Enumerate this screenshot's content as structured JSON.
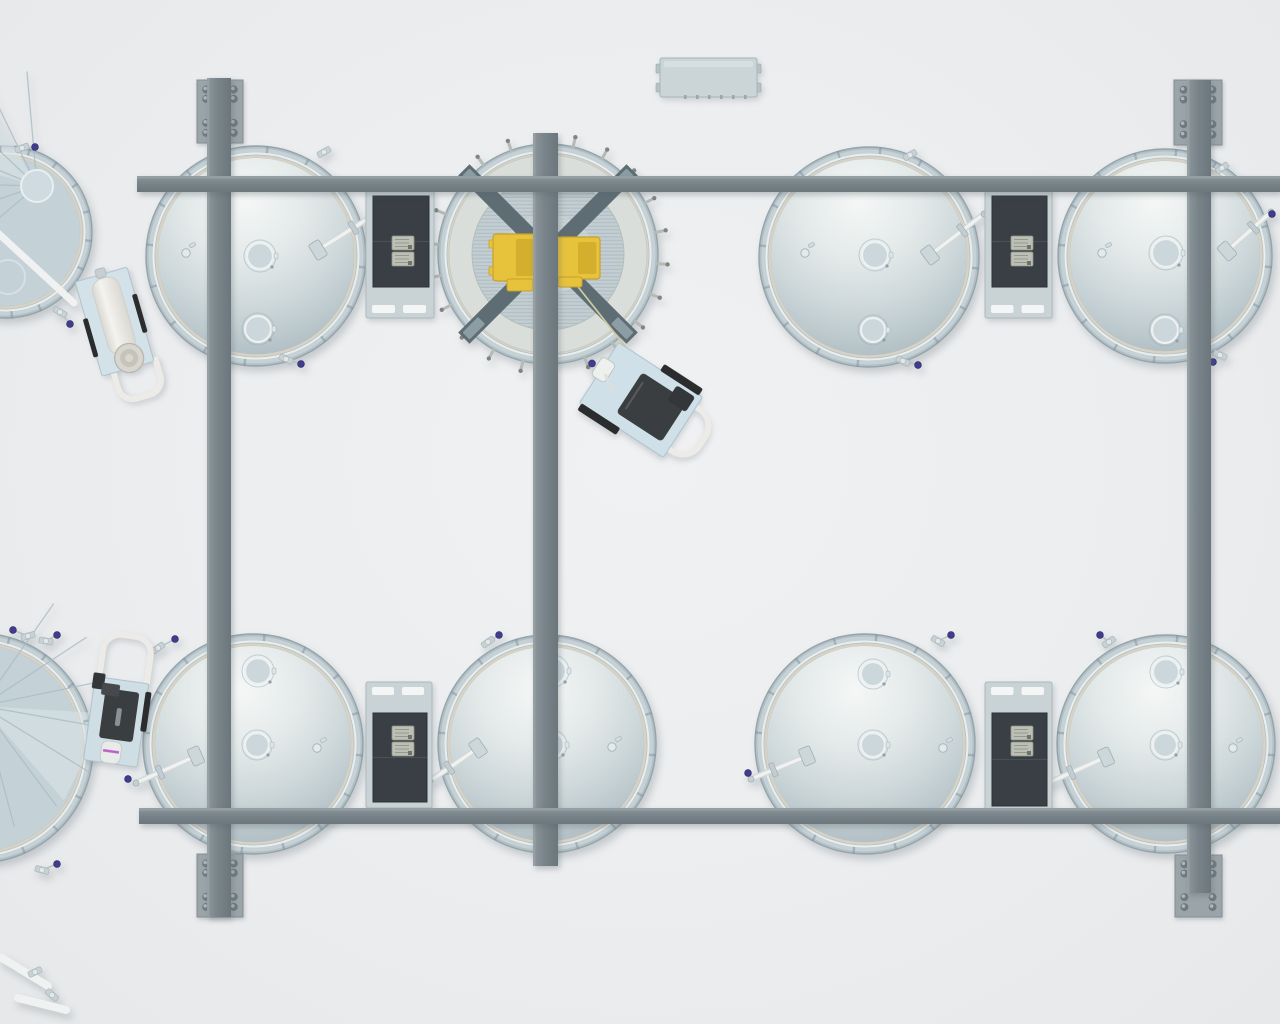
{
  "scene": {
    "canvas": {
      "w": 1280,
      "h": 1024
    },
    "palette": {
      "rim": "#b2c0c6",
      "rim_edge": "#93a4ac",
      "rim_hi": "#c6d1d5",
      "seam_white": "#e9eeee",
      "seam_ring": "#d8d2c4",
      "dome_hi": "#f5f7f6",
      "dome_m1": "#e3e9e9",
      "dome_m2": "#cdd7d9",
      "dome_m3": "#b6c4c9",
      "dome_edge": "#a9b8bf",
      "beam_light": "#8d979c",
      "beam_mid": "#79848a",
      "beam_dark": "#6b767d",
      "plate": "#9ba5a9",
      "plate_edge": "#868f93",
      "bolt": "#6f7a80",
      "bolt_hi": "#adb6ba",
      "panel_base": "#c9d2d5",
      "panel_edge": "#adb9bd",
      "panel_dark": "#393f44",
      "panel_dark_edge": "#2c3235",
      "panel_seam": "#4a5156",
      "keypad": "#bcbfb4",
      "keypad_edge": "#90948b",
      "slot": "#f4f6f6",
      "yellow": "#e7c33c",
      "yellow_dark": "#c79f2b",
      "yellow_shade": "#d4af2e",
      "xbeam": "#5e6d74",
      "xbeam_foot": "#8c9da4",
      "pipe": "#f0f2f1",
      "pipe_shadow": "#d2d9d8",
      "fitting": "#cdd6d9",
      "fitting_edge": "#9fb0b6",
      "knob_purple": "#413c8f",
      "knob_edge": "#26235e",
      "knob_magenta": "#bf5ec6",
      "open_floor": "#dadedb",
      "stripe_a": "#c3ced2",
      "stripe_b": "#b1bec4",
      "open_center": "#ced8da",
      "cone_fill": "#c4d2d8",
      "cone_line": "#a9bcc5",
      "cone_hi": "#d9e3e6",
      "stud": "#b4bab6",
      "stud_tip": "#7e8683",
      "cart_deck": "#d3e2e9",
      "cart_deck_edge": "#b0c3cc",
      "cart_motor": "#3b3e41",
      "cart_bumper": "#2a2c2d",
      "cart_handle": "#edebe7",
      "cylinder_a": "#f4f3ef",
      "cylinder_b": "#d9d8d2",
      "cap": "#d8d6cf",
      "cap_edge": "#b5b3aa",
      "manway_fill": "#cbd7db",
      "manway_edge": "#edf1f2",
      "manway_ring": "#9db0b8",
      "tick": "#7f929b"
    },
    "tanks": [
      {
        "id": "tank-top-far-left",
        "type": "cone",
        "cx": 6,
        "cy": 232,
        "r": 86,
        "apex": {
          "x": 37,
          "y": 186,
          "r": 16
        },
        "fan": {
          "ax": 37,
          "ay": 186,
          "from": 140,
          "to": 265,
          "n": 7,
          "len": 115
        },
        "pipe": {
          "x1": -14,
          "y1": 222,
          "x2": 74,
          "y2": 303
        },
        "extra_circle": {
          "x": 8,
          "y": 277,
          "r": 17
        },
        "fittings": [
          {
            "x": 22,
            "y": 148,
            "rot": -20,
            "knob": {
              "x": 35,
              "y": 147
            }
          },
          {
            "x": 60,
            "y": 312,
            "rot": 30,
            "knob": {
              "x": 70,
              "y": 324
            }
          }
        ]
      },
      {
        "id": "tank-top-1",
        "type": "closed",
        "cx": 256,
        "cy": 256,
        "r": 110,
        "manways": [
          {
            "x": 260,
            "y": 256,
            "r": 13
          },
          {
            "x": 258,
            "y": 329,
            "r": 13
          }
        ],
        "glyph": {
          "x": 186,
          "y": 253
        },
        "arm": {
          "x1": 318,
          "y1": 250,
          "x2": 377,
          "y2": 213,
          "knob": {
            "x": 380,
            "y": 219
          }
        },
        "fittings": [
          {
            "x": 324,
            "y": 152,
            "rot": -30
          },
          {
            "x": 286,
            "y": 359,
            "rot": 25,
            "knob": {
              "x": 301,
              "y": 364
            }
          }
        ]
      },
      {
        "id": "tank-top-2-open",
        "type": "open",
        "cx": 548,
        "cy": 254,
        "r": 110,
        "floor_r": 99,
        "stripe_r": 76,
        "cross_len": 238,
        "cross_w": 16,
        "studs": 22,
        "rod": {
          "x1": 560,
          "y1": 264,
          "x2": 628,
          "y2": 350
        },
        "motors": [
          {
            "x": 493,
            "y": 234,
            "w": 44,
            "h": 47,
            "tab": {
              "x": 507,
              "y": 279,
              "w": 26,
              "h": 12
            }
          },
          {
            "x": 554,
            "y": 237,
            "w": 46,
            "h": 42,
            "tab": {
              "x": 558,
              "y": 277,
              "w": 24,
              "h": 10
            }
          }
        ]
      },
      {
        "id": "tank-top-3",
        "type": "closed",
        "cx": 869,
        "cy": 257,
        "r": 110,
        "manways": [
          {
            "x": 875,
            "y": 255,
            "r": 13
          },
          {
            "x": 873,
            "y": 330,
            "r": 12
          }
        ],
        "glyph": {
          "x": 805,
          "y": 253
        },
        "arm": {
          "x1": 930,
          "y1": 255,
          "x2": 984,
          "y2": 214,
          "knob": {
            "x": 995,
            "y": 220
          }
        },
        "fittings": [
          {
            "x": 910,
            "y": 155,
            "rot": -30
          },
          {
            "x": 903,
            "y": 361,
            "rot": 25,
            "knob": {
              "x": 918,
              "y": 365
            }
          }
        ]
      },
      {
        "id": "tank-top-4",
        "type": "closed",
        "cx": 1165,
        "cy": 256,
        "r": 107,
        "manways": [
          {
            "x": 1166,
            "y": 253,
            "r": 14
          },
          {
            "x": 1165,
            "y": 330,
            "r": 13
          }
        ],
        "glyph": {
          "x": 1102,
          "y": 253
        },
        "arm": {
          "x1": 1227,
          "y1": 251,
          "x2": 1271,
          "y2": 212,
          "knob": {
            "x": 1272,
            "y": 214
          }
        },
        "fittings": [
          {
            "x": 1222,
            "y": 168,
            "rot": -35
          },
          {
            "x": 1220,
            "y": 355,
            "rot": 25,
            "knob": {
              "x": 1213,
              "y": 362
            }
          }
        ]
      },
      {
        "id": "tank-bottom-far-left",
        "type": "cone",
        "cx": -22,
        "cy": 748,
        "r": 115,
        "apex": {
          "x": -18,
          "y": 706,
          "r": 15
        },
        "fan": {
          "ax": -18,
          "ay": 706,
          "from": -55,
          "to": 75,
          "n": 7,
          "len": 125
        },
        "pipes": [
          {
            "x1": 2,
            "y1": 958,
            "x2": 48,
            "y2": 986
          },
          {
            "x1": 18,
            "y1": 998,
            "x2": 66,
            "y2": 1010
          }
        ],
        "fittings": [
          {
            "x": 28,
            "y": 636,
            "rot": -15,
            "knob": {
              "x": 13,
              "y": 630
            }
          },
          {
            "x": 46,
            "y": 641,
            "rot": 10,
            "knob": {
              "x": 57,
              "y": 635
            }
          },
          {
            "x": 42,
            "y": 870,
            "rot": 15,
            "knob": {
              "x": 57,
              "y": 864
            }
          },
          {
            "x": 35,
            "y": 972,
            "rot": -25
          },
          {
            "x": 52,
            "y": 995,
            "rot": 40
          }
        ]
      },
      {
        "id": "tank-bottom-1",
        "type": "closed",
        "cx": 253,
        "cy": 744,
        "r": 110,
        "manways": [
          {
            "x": 258,
            "y": 671,
            "r": 13
          },
          {
            "x": 257,
            "y": 745,
            "r": 12
          }
        ],
        "glyph": {
          "x": 317,
          "y": 748
        },
        "arm": {
          "x1": 196,
          "y1": 756,
          "x2": 136,
          "y2": 783,
          "knob": {
            "x": 128,
            "y": 779
          }
        },
        "fittings": [
          {
            "x": 158,
            "y": 648,
            "rot": -35,
            "knob": {
              "x": 175,
              "y": 639
            }
          }
        ]
      },
      {
        "id": "tank-bottom-2",
        "type": "closed",
        "cx": 547,
        "cy": 744,
        "r": 109,
        "manways": [
          {
            "x": 553,
            "y": 671,
            "r": 13
          },
          {
            "x": 552,
            "y": 745,
            "r": 12
          }
        ],
        "glyph": {
          "x": 612,
          "y": 747
        },
        "arm": {
          "x1": 478,
          "y1": 748,
          "x2": 430,
          "y2": 781,
          "knob": {
            "x": 421,
            "y": 779
          }
        },
        "fittings": [
          {
            "x": 488,
            "y": 642,
            "rot": -35,
            "knob": {
              "x": 499,
              "y": 635
            }
          }
        ]
      },
      {
        "id": "tank-bottom-3",
        "type": "closed",
        "cx": 865,
        "cy": 744,
        "r": 110,
        "manways": [
          {
            "x": 873,
            "y": 674,
            "r": 12
          },
          {
            "x": 873,
            "y": 745,
            "r": 12
          }
        ],
        "glyph": {
          "x": 943,
          "y": 748
        },
        "arm": {
          "x1": 807,
          "y1": 756,
          "x2": 751,
          "y2": 779,
          "knob": {
            "x": 748,
            "y": 773
          }
        },
        "fittings": [
          {
            "x": 938,
            "y": 641,
            "rot": 30,
            "knob": {
              "x": 951,
              "y": 635
            }
          }
        ]
      },
      {
        "id": "tank-bottom-4",
        "type": "closed",
        "cx": 1166,
        "cy": 744,
        "r": 109,
        "manways": [
          {
            "x": 1166,
            "y": 672,
            "r": 13
          },
          {
            "x": 1165,
            "y": 745,
            "r": 12
          }
        ],
        "glyph": {
          "x": 1233,
          "y": 748
        },
        "arm": {
          "x1": 1106,
          "y1": 757,
          "x2": 1048,
          "y2": 783,
          "knob": {
            "x": 1040,
            "y": 779
          }
        },
        "fittings": [
          {
            "x": 1109,
            "y": 642,
            "rot": -35,
            "knob": {
              "x": 1100,
              "y": 635
            }
          }
        ]
      }
    ],
    "beams": {
      "horizontal": [
        {
          "id": "beam-h-top",
          "x": 137,
          "y": 176,
          "w": 1143,
          "h": 16
        },
        {
          "id": "beam-h-bottom",
          "x": 139,
          "y": 808,
          "w": 1141,
          "h": 16
        }
      ],
      "vertical": [
        {
          "id": "beam-v-left",
          "x": 207,
          "y": 78,
          "w": 24,
          "h": 839
        },
        {
          "id": "beam-v-center",
          "x": 533,
          "y": 133,
          "w": 25,
          "h": 733
        },
        {
          "id": "beam-v-right",
          "x": 1187,
          "y": 80,
          "w": 24,
          "h": 813
        }
      ],
      "plates": [
        {
          "id": "endplate-top-left",
          "x": 197,
          "y": 80,
          "w": 46,
          "h": 63
        },
        {
          "id": "endplate-bottom-left",
          "x": 197,
          "y": 854,
          "w": 46,
          "h": 63
        },
        {
          "id": "endplate-top-right",
          "x": 1174,
          "y": 80,
          "w": 48,
          "h": 65
        },
        {
          "id": "endplate-bottom-right",
          "x": 1175,
          "y": 855,
          "w": 47,
          "h": 62
        }
      ]
    },
    "panels": [
      {
        "id": "control-panel-top-left",
        "x": 366,
        "y": 190,
        "w": 68,
        "h": 128,
        "orient": "down"
      },
      {
        "id": "control-panel-top-right",
        "x": 985,
        "y": 190,
        "w": 67,
        "h": 128,
        "orient": "down"
      },
      {
        "id": "control-panel-bottom-left",
        "x": 366,
        "y": 682,
        "w": 66,
        "h": 126,
        "orient": "up"
      },
      {
        "id": "control-panel-bottom-right",
        "x": 985,
        "y": 682,
        "w": 67,
        "h": 130,
        "orient": "up"
      }
    ],
    "carts": [
      {
        "id": "cart-filter-trolley",
        "kind": "cylinder",
        "x": 118,
        "y": 330,
        "rot": -16
      },
      {
        "id": "cart-pump-center",
        "kind": "pump-east",
        "x": 641,
        "y": 400,
        "rot": 33
      },
      {
        "id": "cart-pump-bottom-left",
        "kind": "pump-north",
        "x": 118,
        "y": 716,
        "rot": 8
      }
    ],
    "top_box": {
      "id": "junction-box",
      "x": 660,
      "y": 58,
      "w": 97,
      "h": 39,
      "ticks": 6
    }
  }
}
